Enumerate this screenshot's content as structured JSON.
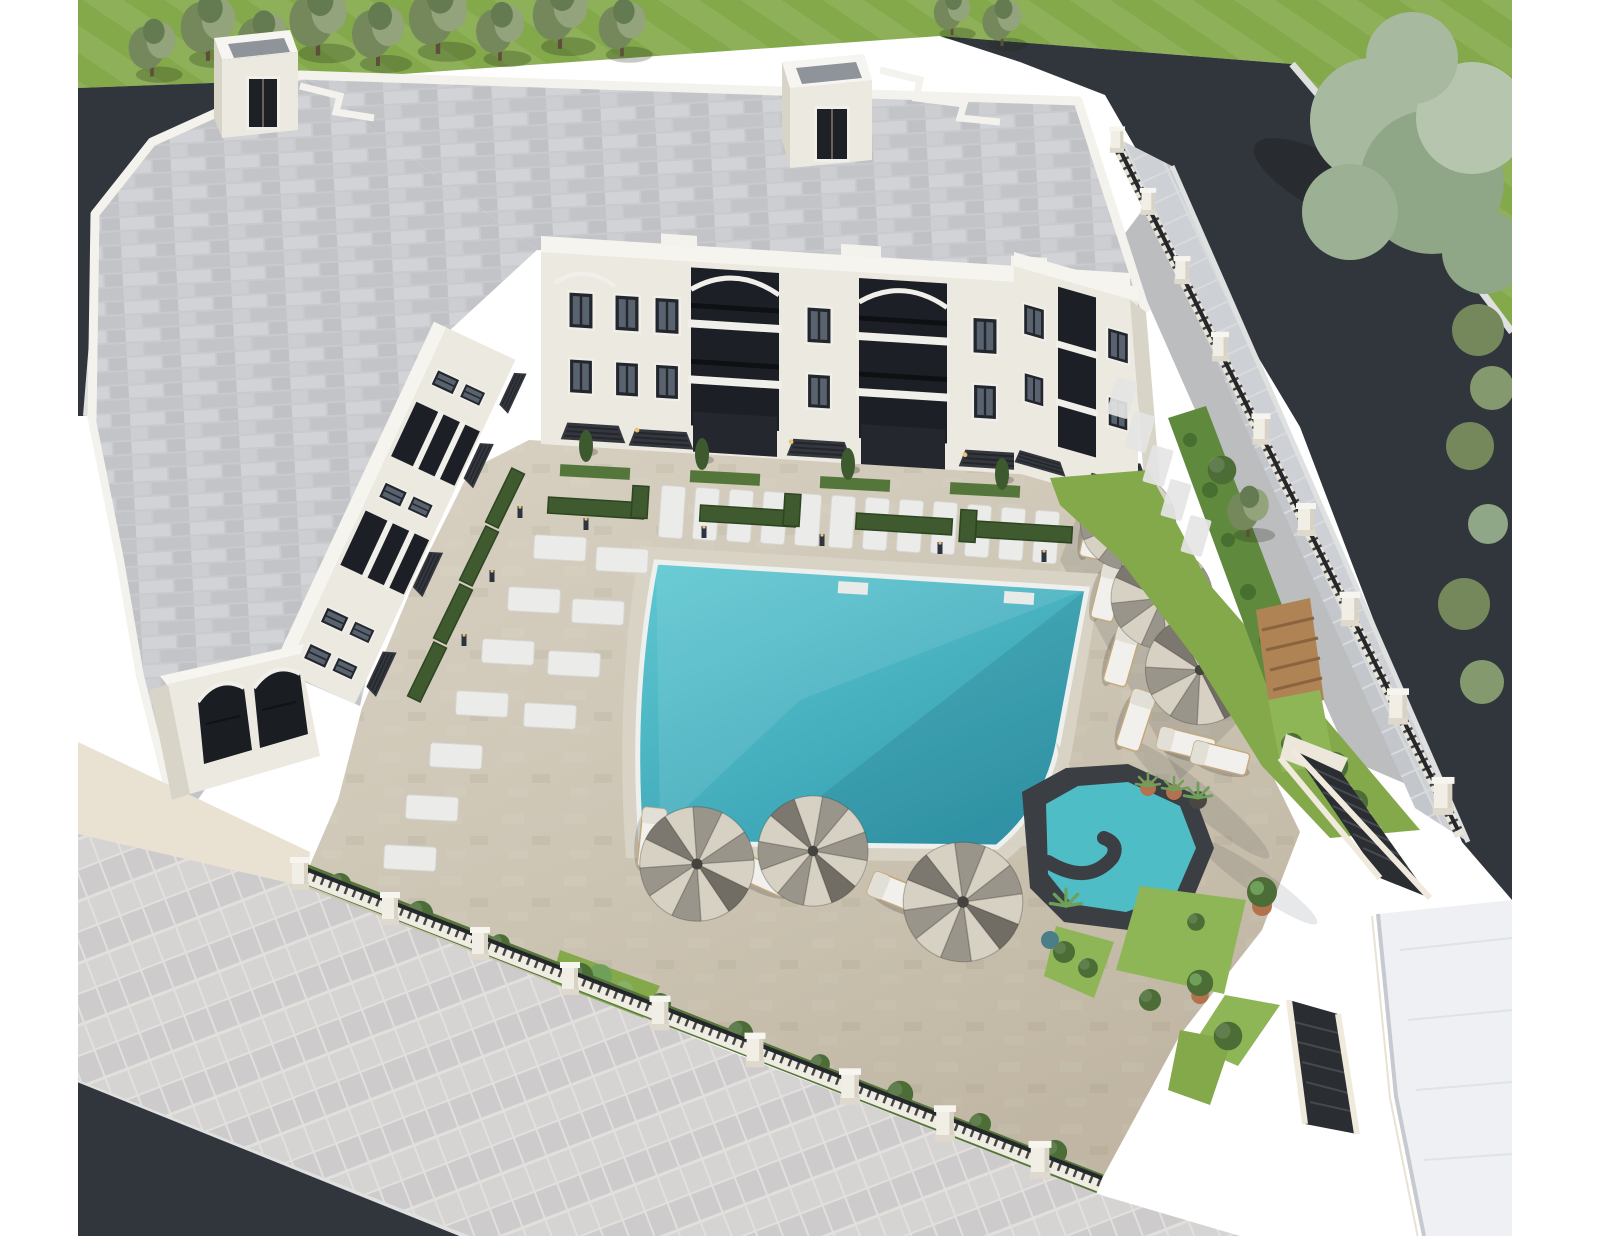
{
  "scene": {
    "title": "Aerial 3D rendering of a residential courtyard complex with swimming pool",
    "view": "high-angle aerial, slightly oblique, daytime",
    "canvas": {
      "width": 1600,
      "height": 1236,
      "content_left": 78,
      "content_right": 1512
    }
  },
  "palette": {
    "page_bg": "#ffffff",
    "grass_base": "#83a94b",
    "grass_bright": "#8fb656",
    "road_asphalt": "#31353c",
    "road_shadow": "#262a30",
    "curb": "#dfe1e0",
    "sidewalk_tile": "#cfd0d3",
    "roof_tile": "#c8cacd",
    "parapet_white": "#f3f2ed",
    "wall_white": "#ece9e1",
    "wall_shade": "#d9d4c8",
    "fascia": "#f6f4ef",
    "window_dark": "#23262c",
    "awning": "#34373d",
    "court_tan": "#cdc5b4",
    "court_light": "#dad3c4",
    "deck_light": "#d9d3c6",
    "coping": "#eef0ee",
    "pool_shallow": "#5fc8d2",
    "pool_deep": "#369fb1",
    "jacuzzi": "#4fbdc6",
    "stone_dark": "#3b3f43",
    "hedge_dark": "#3e5a2e",
    "hedge_mid": "#55763a",
    "greenwall": "#5f8a3e",
    "tree_olive": "#74885c",
    "tree_olive_light": "#93a47c",
    "tree_pale": "#a7b99e",
    "bush": "#4c6d36",
    "wood": "#b08354",
    "terracotta": "#b4714e",
    "white_pad": "#ebebe9",
    "lounger": "#f1f0ec",
    "umb_light": "#d7d1c3",
    "umb_mid": "#9a958b",
    "umb_dark": "#716d65",
    "pillar": "#f1eee6",
    "railing": "#24272c",
    "white_roof": "#eef0f3",
    "apron": "#e9e1d1",
    "light_warm": "#e9c27c"
  },
  "inventory": {
    "building": {
      "type": "U-shaped residential block",
      "floors": 3,
      "roof_access_towers": 2,
      "facade": "white stucco with dark-framed windows, dark metal balcony railings and decorative arches",
      "ground_floor": "patios with dark pergola awnings, hedge planters and bollard lights",
      "entrance": "double-arched white portico at lower left"
    },
    "pool_area": {
      "main_pool": "large rotated-rectangle pool with rounded lower-right beach corner and entry steps",
      "spa_pool": "hexagonal spa with dark stone spiral surround",
      "sun_pads_top_row": 12,
      "sun_pads_left_columns": 11,
      "sun_loungers": 9,
      "parasols_right": 3,
      "parasols_bottom": 3
    },
    "landscape": {
      "lawns": "striped mowed grass on two sides",
      "olive_trees_top": 9,
      "large_tree_top_right": 1,
      "green_wall_right": 1,
      "pergola_bench": 1,
      "potted_plants": 7,
      "hedge_strips": "along fences, facades and spa garden"
    },
    "circulation": {
      "roads": [
        "narrow strip upper left",
        "wide diagonal on right",
        "bottom-left corner"
      ],
      "sidewalks": [
        "wide diagonal band bottom-left",
        "outside right fence"
      ],
      "exterior_stairs": 2,
      "perimeter_fence": "cream pillars with dark metal railings on low cream wall"
    },
    "neighboring_white_roof_bottom_right": true
  }
}
